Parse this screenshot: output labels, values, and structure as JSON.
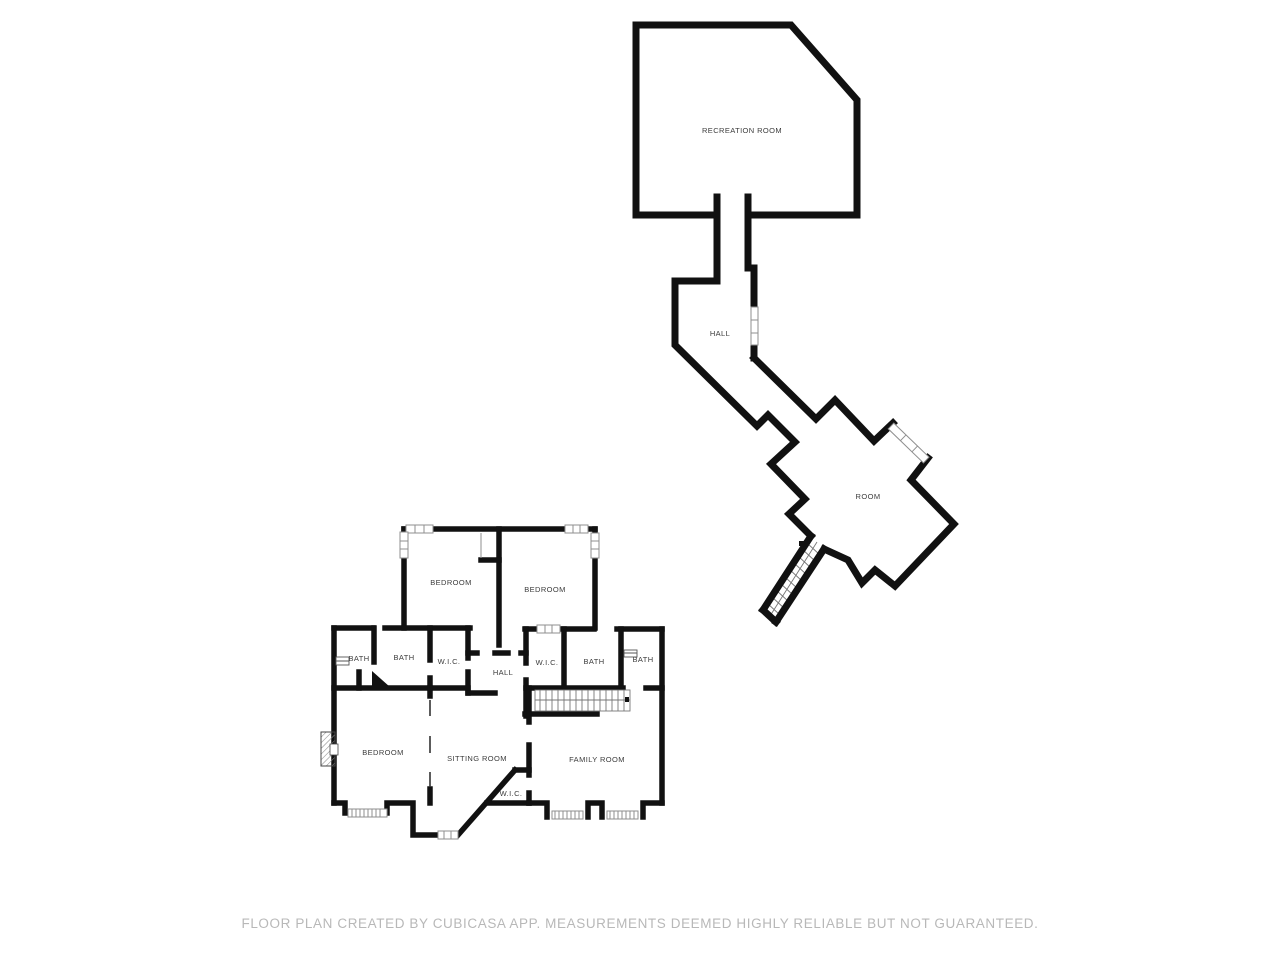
{
  "upper_floor": {
    "rooms": [
      {
        "label": "RECREATION ROOM"
      },
      {
        "label": "HALL"
      },
      {
        "label": "ROOM"
      }
    ]
  },
  "lower_floor": {
    "rooms": [
      {
        "label": "BEDROOM"
      },
      {
        "label": "BEDROOM"
      },
      {
        "label": "BATH"
      },
      {
        "label": "BATH"
      },
      {
        "label": "W.I.C."
      },
      {
        "label": "HALL"
      },
      {
        "label": "W.I.C."
      },
      {
        "label": "BATH"
      },
      {
        "label": "BATH"
      },
      {
        "label": "BEDROOM"
      },
      {
        "label": "SITTING ROOM"
      },
      {
        "label": "FAMILY ROOM"
      },
      {
        "label": "W.I.C."
      }
    ]
  },
  "footer": {
    "disclaimer": "FLOOR PLAN CREATED BY CUBICASA APP. MEASUREMENTS DEEMED HIGHLY RELIABLE BUT NOT GUARANTEED."
  },
  "colors": {
    "wall": "#111111",
    "background": "#ffffff",
    "label_text": "#3c3c3c",
    "footer_text": "#b8b8b8",
    "window_line": "#8f8f8f",
    "stair_line": "#777777"
  }
}
